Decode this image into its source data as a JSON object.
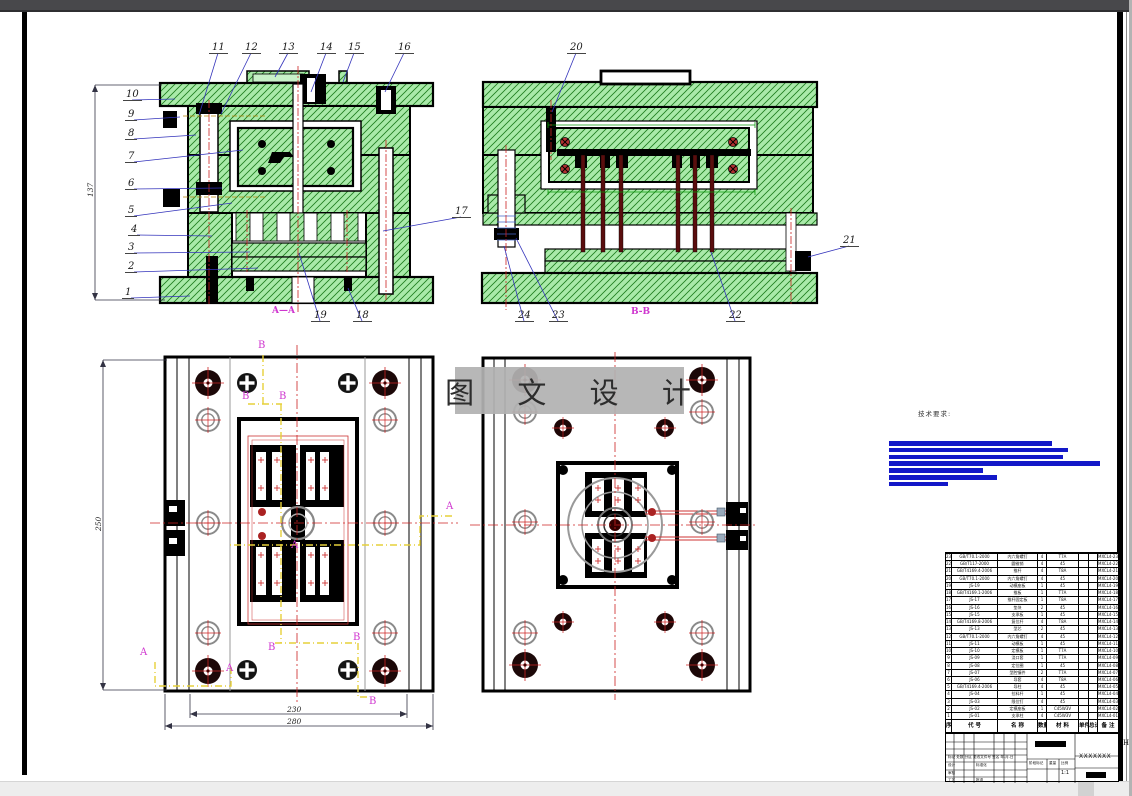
{
  "page": {
    "zone_marker": "H"
  },
  "views": {
    "section_aa": {
      "label": "A—A"
    },
    "section_bb": {
      "label": "B-B"
    }
  },
  "callouts": [
    "1",
    "2",
    "3",
    "4",
    "5",
    "6",
    "7",
    "8",
    "9",
    "10",
    "11",
    "12",
    "13",
    "14",
    "15",
    "16",
    "17",
    "18",
    "19",
    "20",
    "21",
    "22",
    "23",
    "24"
  ],
  "dimensions": {
    "aa_height": "137",
    "plan_height": "250",
    "plan_width_inner": "230",
    "plan_width_outer": "280"
  },
  "section_letters": {
    "a": "A",
    "b": "B"
  },
  "watermark": {
    "text": "图 文 设 计"
  },
  "tech_requirements": {
    "label": "技术要求:",
    "bars": [
      163,
      179,
      174,
      211,
      94,
      108,
      59
    ]
  },
  "parts_table": {
    "headers": [
      "序",
      "代 号",
      "名 称",
      "数量",
      "材 料",
      "单件",
      "总计",
      "备 注"
    ],
    "rows": [
      [
        "23",
        "GB/T70.1-2000",
        "内六角螺钉",
        "4",
        "T7A",
        "",
        "",
        "MXCL4-23"
      ],
      [
        "22",
        "GB/T117-2000",
        "圆锥销",
        "4",
        "45",
        "",
        "",
        "MXCL4-22"
      ],
      [
        "21",
        "GB/T4169.4-2006",
        "推杆",
        "4",
        "T8A",
        "",
        "",
        "MXCL4-21"
      ],
      [
        "20",
        "GB/T70.1-2000",
        "内六角螺钉",
        "4",
        "45",
        "",
        "",
        "MXCL4-20"
      ],
      [
        "19",
        "JS-19",
        "动模座板",
        "1",
        "45",
        "",
        "",
        "MXCL4-19"
      ],
      [
        "18",
        "GB/T4169.1-2006",
        "推板",
        "1",
        "T7A",
        "",
        "",
        "MXCL4-18"
      ],
      [
        "17",
        "JS-17",
        "推杆固定板",
        "1",
        "T8A",
        "",
        "",
        "MXCL4-17"
      ],
      [
        "16",
        "JS-16",
        "垫块",
        "2",
        "45",
        "",
        "",
        "MXCL4-16"
      ],
      [
        "15",
        "JS-15",
        "支承板",
        "1",
        "45",
        "",
        "",
        "MXCL4-15"
      ],
      [
        "14",
        "GB/T4169.8-2006",
        "复位杆",
        "4",
        "T8A",
        "",
        "",
        "MXCL4-14"
      ],
      [
        "13",
        "JS-13",
        "型芯",
        "2",
        "45",
        "",
        "",
        "MXCL4-13"
      ],
      [
        "12",
        "GB/T70.1-2000",
        "内六角螺钉",
        "4",
        "45",
        "",
        "",
        "MXCL4-12"
      ],
      [
        "11",
        "JS-11",
        "动模板",
        "1",
        "45",
        "",
        "",
        "MXCL4-11"
      ],
      [
        "10",
        "JS-10",
        "定模板",
        "1",
        "T7A",
        "",
        "",
        "MXCL4-10"
      ],
      [
        "9",
        "JS-09",
        "浇口套",
        "1",
        "T7A",
        "",
        "",
        "MXCL4-09"
      ],
      [
        "8",
        "JS-08",
        "定位圈",
        "1",
        "45",
        "",
        "",
        "MXCL4-08"
      ],
      [
        "7",
        "JS-07",
        "型腔镶件",
        "2",
        "T7A",
        "",
        "",
        "MXCL4-07"
      ],
      [
        "6",
        "JS-06",
        "导套",
        "4",
        "T8A",
        "",
        "",
        "MXCL4-06"
      ],
      [
        "5",
        "GB/T4169.4-2006",
        "导柱",
        "4",
        "45",
        "",
        "",
        "MXCL4-05"
      ],
      [
        "4",
        "JS-04",
        "拉料杆",
        "1",
        "45",
        "",
        "",
        "MXCL4-04"
      ],
      [
        "3",
        "JS-03",
        "限位钉",
        "4",
        "45",
        "",
        "",
        "MXCL4-03"
      ],
      [
        "2",
        "JS-02",
        "定模座板",
        "1",
        "C45W3V",
        "",
        "",
        "MXCL4-02"
      ],
      [
        "1",
        "JS-01",
        "支承柱",
        "4",
        "C45W3V",
        "",
        "",
        "MXCL4-01"
      ]
    ]
  },
  "title_block": {
    "code": "XXXXXXX",
    "scale_value": "1:1",
    "labels": {
      "stage": "阶段标记",
      "weight": "重量",
      "scale": "比例",
      "mark_row": "标记 处数 分区 更改文件号 签名 年.月.日",
      "design": "设计",
      "standard": "标准化",
      "check": "审核",
      "process": "工艺",
      "approve": "批准"
    }
  },
  "colors": {
    "hatch_fill": "#a9eaa9",
    "hatch_line": "#1e7d1e",
    "leader_blue": "#3333bb",
    "centerline_red": "#cc2222",
    "section_magenta": "#cf35cf",
    "section_line_yellow": "#e6d03a",
    "redact_blue": "#1318c8"
  }
}
